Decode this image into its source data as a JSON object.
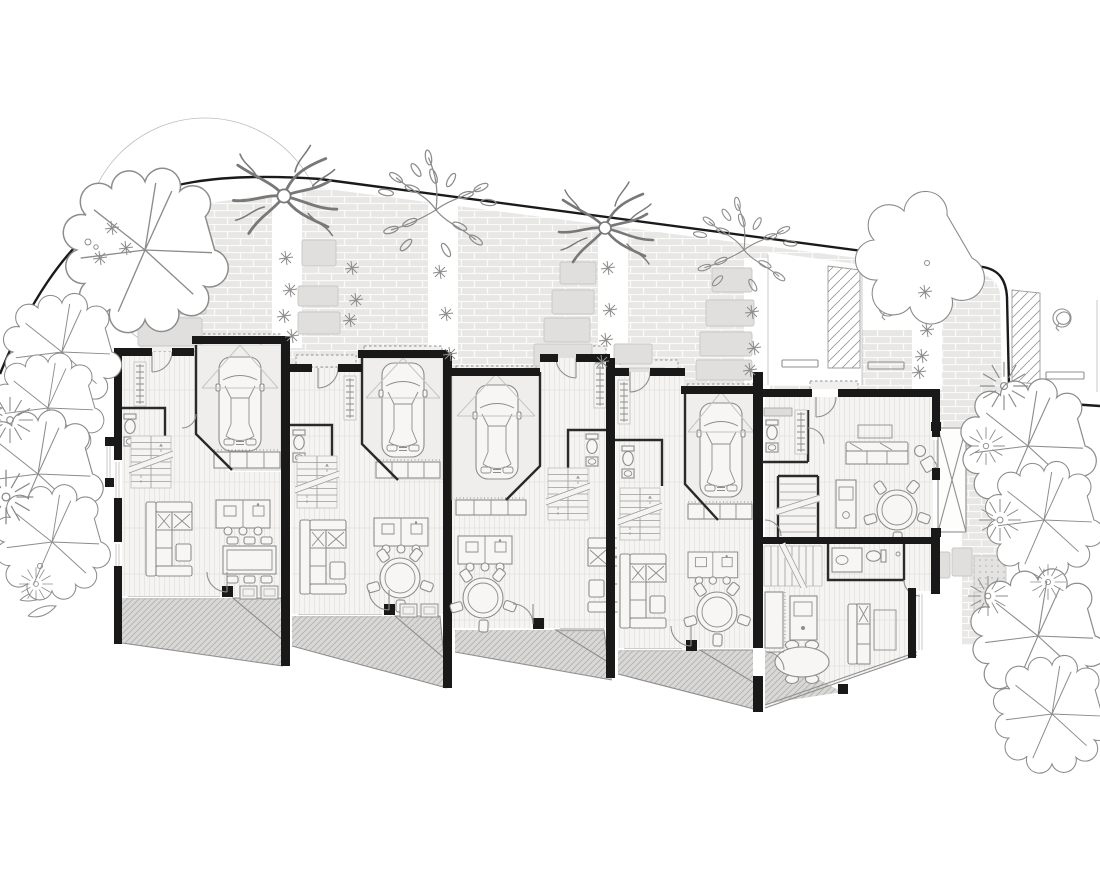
{
  "document": {
    "type": "architectural site & ground-floor plan",
    "label": "Black-and-white architectural plan of five terraced houses with garages, parked cars, open-plan living areas, rear terraces, a curved access road, brick-paved driveway, stepping-stone paths, parking and bicycle stalls, and garden trees",
    "visible_text": "none"
  },
  "colors": {
    "paper": "#ffffff",
    "ink": "#2a2a2a",
    "wall": "#191919",
    "road": "#1a1a1a",
    "line": "#8f8f8f",
    "soft": "#bdbdbc",
    "floor": "#f5f4f2",
    "garage": "#efeeec",
    "paving": "#e8e7e5",
    "pavingline": "#fafaf9",
    "stone": "#e0dfde",
    "stoneline": "#c8c7c5",
    "terrace": "#d9d8d6",
    "hatchline": "#b0b0ae",
    "veg": "#8c8c8c",
    "furn": "#8d8d8d",
    "furnfill": "#f7f6f5"
  },
  "site": {
    "road": "curved access road along top boundary",
    "driveway": "brick-paved shared drive with planting strips",
    "planting_strips": 5,
    "stepping_stone_paths": 5,
    "parking_space_markers": 3,
    "bike_racks": 2,
    "hatched_stalls": 2,
    "canopy_trees": 9,
    "cloud_trees": 1,
    "leaf_trees": 2,
    "branch_trees": 2,
    "sunburst_shrubs": 8
  },
  "units": [
    {
      "id": "house-1",
      "label": "House 1 — entry hall, WC, garage with car, stairs, open-plan kitchen, 8-seat dining table, lounge, rear terrace"
    },
    {
      "id": "house-2",
      "label": "House 2 — entry hall, WC, garage with car, stairs, open-plan kitchen, round dining table, lounge, rear terrace"
    },
    {
      "id": "house-3",
      "label": "House 3 — garage with car, entry hall, WC, stairs, open-plan kitchen, round dining table, lounge, rear terrace"
    },
    {
      "id": "house-4",
      "label": "House 4 — entry hall, WC, garage with car, stairs, open-plan kitchen, round dining table, lounge, rear terrace"
    },
    {
      "id": "house-5a",
      "label": "House 5 upper flat — entry, WC, stairs, kitchen, round dining table, lounge, side bridge deck"
    },
    {
      "id": "house-5b",
      "label": "House 5 lower flat — stairs, bathroom, kitchen, oval dining table, lounge, rear terrace"
    }
  ],
  "stamps": [
    {
      "layer": "layer-stones",
      "type": "rect",
      "name": "stepping-stone",
      "cls": "stone",
      "items": [
        [
          148,
          198,
          42,
          24
        ],
        [
          152,
          228,
          34,
          24
        ],
        [
          144,
          256,
          46,
          28
        ],
        [
          148,
          290,
          58,
          24
        ],
        [
          138,
          318,
          64,
          28
        ],
        [
          302,
          240,
          34,
          26
        ],
        [
          298,
          286,
          40,
          20
        ],
        [
          298,
          312,
          42,
          22
        ],
        [
          560,
          262,
          36,
          22
        ],
        [
          552,
          290,
          42,
          24
        ],
        [
          544,
          318,
          46,
          24
        ],
        [
          534,
          344,
          58,
          22
        ],
        [
          524,
          368,
          64,
          20
        ],
        [
          614,
          344,
          38,
          20
        ],
        [
          612,
          368,
          54,
          18
        ],
        [
          712,
          268,
          40,
          24
        ],
        [
          706,
          300,
          48,
          26
        ],
        [
          700,
          332,
          52,
          24
        ],
        [
          696,
          360,
          56,
          20
        ],
        [
          928,
          552,
          22,
          26
        ],
        [
          952,
          548,
          20,
          28
        ]
      ]
    },
    {
      "layer": "layer-veg",
      "type": "use",
      "symbol": "s-canopy",
      "name": "canopy-tree",
      "items": [
        [
          145,
          250,
          1.34
        ],
        [
          62,
          352,
          0.96
        ],
        [
          48,
          408,
          0.9
        ],
        [
          38,
          474,
          1.05
        ],
        [
          52,
          542,
          0.94
        ],
        [
          1028,
          446,
          1.1
        ],
        [
          1044,
          520,
          0.96
        ],
        [
          1038,
          636,
          1.1
        ],
        [
          1052,
          714,
          0.96
        ]
      ]
    },
    {
      "layer": "layer-veg",
      "type": "use",
      "symbol": "s-shrub",
      "name": "sunburst-shrub",
      "items": [
        [
          10,
          420,
          1.1
        ],
        [
          6,
          497,
          1.3
        ],
        [
          36,
          584,
          0.8
        ],
        [
          1004,
          386,
          1.15
        ],
        [
          986,
          446,
          0.9
        ],
        [
          1000,
          520,
          1.0
        ],
        [
          988,
          596,
          0.95
        ],
        [
          1048,
          582,
          0.85
        ]
      ]
    },
    {
      "layer": "layer-veg",
      "type": "use",
      "symbol": "s-sprig",
      "name": "leaf-tree",
      "items": [
        [
          436,
          210,
          1.25
        ],
        [
          744,
          250,
          1.1
        ]
      ]
    },
    {
      "layer": "layer-veg",
      "type": "use",
      "symbol": "s-branch",
      "name": "branch-tree",
      "items": [
        [
          284,
          196,
          1.1
        ],
        [
          605,
          228,
          1.0
        ]
      ]
    },
    {
      "layer": "layer-veg",
      "type": "use",
      "symbol": "s-cloud",
      "name": "cloud-tree",
      "items": [
        [
          922,
          258,
          1.0
        ]
      ]
    },
    {
      "layer": "layer-veg",
      "type": "use",
      "symbol": "s-star",
      "name": "plant",
      "items": [
        [
          286,
          258,
          1
        ],
        [
          290,
          290,
          1
        ],
        [
          284,
          316,
          1
        ],
        [
          292,
          336,
          1
        ],
        [
          352,
          268,
          1
        ],
        [
          356,
          300,
          1
        ],
        [
          350,
          320,
          1
        ],
        [
          440,
          272,
          1
        ],
        [
          446,
          314,
          1
        ],
        [
          450,
          354,
          1
        ],
        [
          608,
          268,
          1
        ],
        [
          610,
          310,
          1
        ],
        [
          606,
          340,
          1
        ],
        [
          602,
          362,
          1
        ],
        [
          752,
          312,
          1
        ],
        [
          754,
          348,
          1
        ],
        [
          750,
          370,
          1
        ],
        [
          925,
          292,
          1
        ],
        [
          927,
          330,
          1
        ],
        [
          922,
          356,
          1
        ],
        [
          919,
          372,
          1
        ],
        [
          112,
          228,
          1
        ],
        [
          126,
          248,
          1
        ],
        [
          100,
          258,
          1
        ]
      ]
    },
    {
      "layer": "layer-veg",
      "type": "circle",
      "name": "pebble",
      "items": [
        [
          88,
          242,
          3
        ],
        [
          96,
          247,
          2.2
        ],
        [
          927,
          263,
          2.5
        ],
        [
          40,
          566,
          2.5
        ]
      ]
    }
  ]
}
